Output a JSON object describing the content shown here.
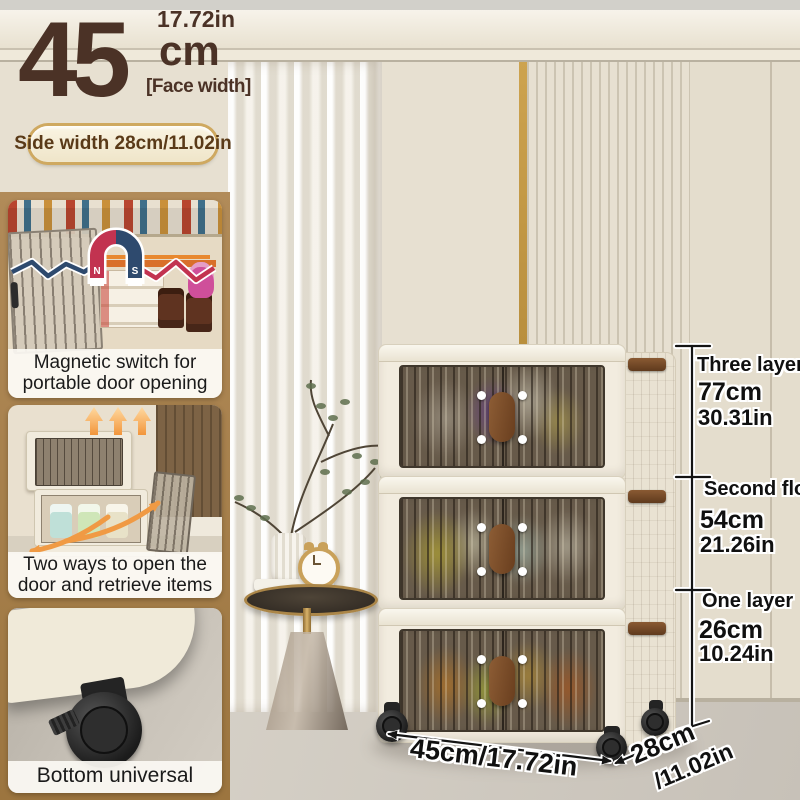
{
  "header": {
    "face_width_value": "45",
    "face_width_unit": "cm",
    "face_width_inches": "17.72in",
    "face_width_label": "[Face width]",
    "side_width_badge": "Side width 28cm/11.02in"
  },
  "features": {
    "magnetic": {
      "line1": "Magnetic switch for",
      "line2": "portable door opening",
      "magnet_n": "N",
      "magnet_s": "S"
    },
    "two_ways": {
      "line1": "Two ways to open the",
      "line2": "door and retrieve items"
    },
    "pulley": {
      "caption": "Bottom universal pulley"
    }
  },
  "measurements": {
    "total": {
      "label": "Three layers",
      "cm": "77cm",
      "inches": "30.31in"
    },
    "second": {
      "label": "Second floor",
      "cm": "54cm",
      "inches": "21.26in"
    },
    "first": {
      "label": "One layer",
      "cm": "26cm",
      "inches": "10.24in"
    },
    "width": "45cm/17.72in",
    "depth_cm": "28cm",
    "depth_inches": "/11.02in"
  },
  "colors": {
    "accent_brown": "#4b3226",
    "panel_brown": "#a47d4c",
    "badge_gold": "#cfa960",
    "magnet_red": "#c23350",
    "magnet_blue": "#2e4a6e",
    "arrow_orange": "#f09a44"
  }
}
